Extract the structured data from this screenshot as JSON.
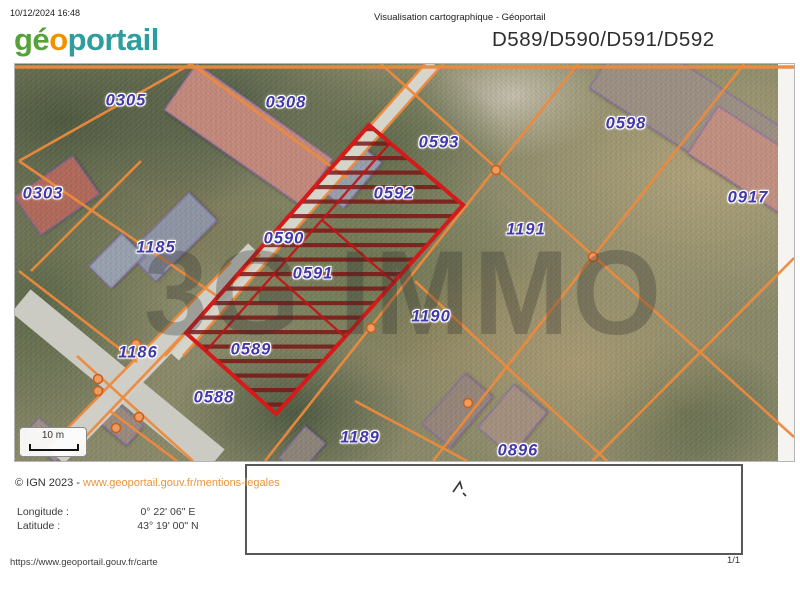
{
  "header": {
    "timestamp": "10/12/2024 16:48",
    "doc_title": "Visualisation cartographique - Géoportail",
    "logo": {
      "geo": "gé",
      "o": "o",
      "portail": "portail"
    },
    "parcels_title": "D589/D590/D591/D592"
  },
  "map": {
    "watermark": "3G IMMO",
    "scale_label": "10 m",
    "label_color": "#4338a8",
    "parcels": [
      {
        "id": "0305",
        "x": 111,
        "y": 37
      },
      {
        "id": "0308",
        "x": 271,
        "y": 39
      },
      {
        "id": "0303",
        "x": 28,
        "y": 130
      },
      {
        "id": "1185",
        "x": 141,
        "y": 184
      },
      {
        "id": "0593",
        "x": 424,
        "y": 79
      },
      {
        "id": "0592",
        "x": 379,
        "y": 130
      },
      {
        "id": "0590",
        "x": 269,
        "y": 175
      },
      {
        "id": "0591",
        "x": 298,
        "y": 210
      },
      {
        "id": "0598",
        "x": 611,
        "y": 60
      },
      {
        "id": "0917",
        "x": 733,
        "y": 134
      },
      {
        "id": "1191",
        "x": 511,
        "y": 166
      },
      {
        "id": "1190",
        "x": 416,
        "y": 253
      },
      {
        "id": "1186",
        "x": 123,
        "y": 289
      },
      {
        "id": "0589",
        "x": 236,
        "y": 286
      },
      {
        "id": "0588",
        "x": 199,
        "y": 334
      },
      {
        "id": "1189",
        "x": 345,
        "y": 374
      },
      {
        "id": "0896",
        "x": 503,
        "y": 387
      }
    ],
    "highlighted_parcels": [
      "0589",
      "0590",
      "0591",
      "0592"
    ]
  },
  "footer": {
    "copyright_prefix": "© IGN 2023 - ",
    "copyright_link": "www.geoportail.gouv.fr/mentions-legales",
    "longitude_label": "Longitude :",
    "longitude_value": "0° 22' 06\" E",
    "latitude_label": "Latitude :",
    "latitude_value": "43° 19' 00\" N",
    "source_url": "https://www.geoportail.gouv.fr/carte",
    "page_indicator": "1/1"
  },
  "colors": {
    "cadastral_line": "#ed8a3d",
    "highlight_red": "#d51a1a",
    "hatch_red": "#7a1412",
    "parcel_label": "#4338a8",
    "link_orange": "#e6953f",
    "logo_green": "#55a238",
    "logo_orange": "#f29100",
    "logo_teal": "#2d9d9e"
  }
}
